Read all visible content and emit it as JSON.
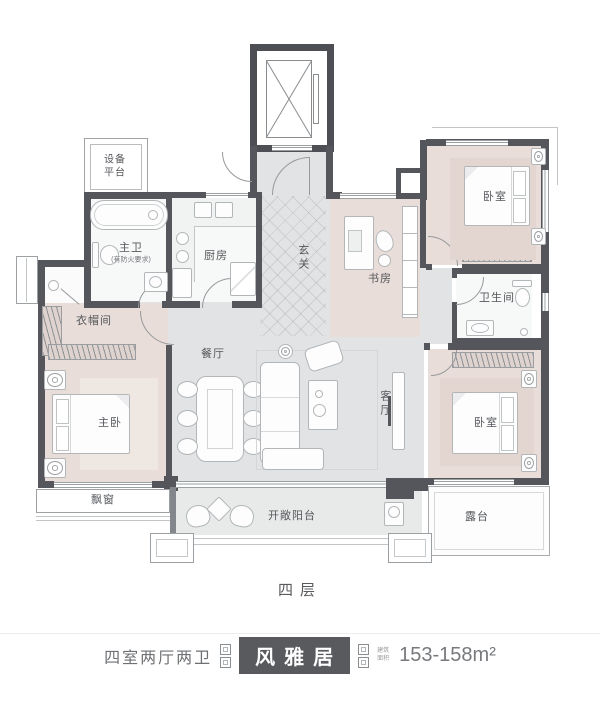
{
  "plan": {
    "floor_label": "四层",
    "rooms": {
      "equipment_platform": "设备平台",
      "master_bath": "主卫",
      "master_bath_note": "(有防火要求)",
      "kitchen": "厨房",
      "foyer": "玄关",
      "study": "书房",
      "bedroom_top_right": "卧室",
      "bathroom": "卫生间",
      "cloakroom": "衣帽间",
      "master_bedroom": "主卧",
      "dining_room": "餐厅",
      "living_room": "客厅",
      "bedroom_bottom_right": "卧室",
      "bay_window": "飘窗",
      "balcony": "开敞阳台",
      "terrace": "露台"
    }
  },
  "footer": {
    "layout_type": "四室两厅两卫",
    "unit_name": "风雅居",
    "area_label": "建筑面积",
    "area_value": "153-158m²"
  },
  "colors": {
    "wall": "#54565b",
    "bedroom_floor": "#e8ddd8",
    "common_floor": "#e2e3e4",
    "banner_box": "#595a5e"
  }
}
